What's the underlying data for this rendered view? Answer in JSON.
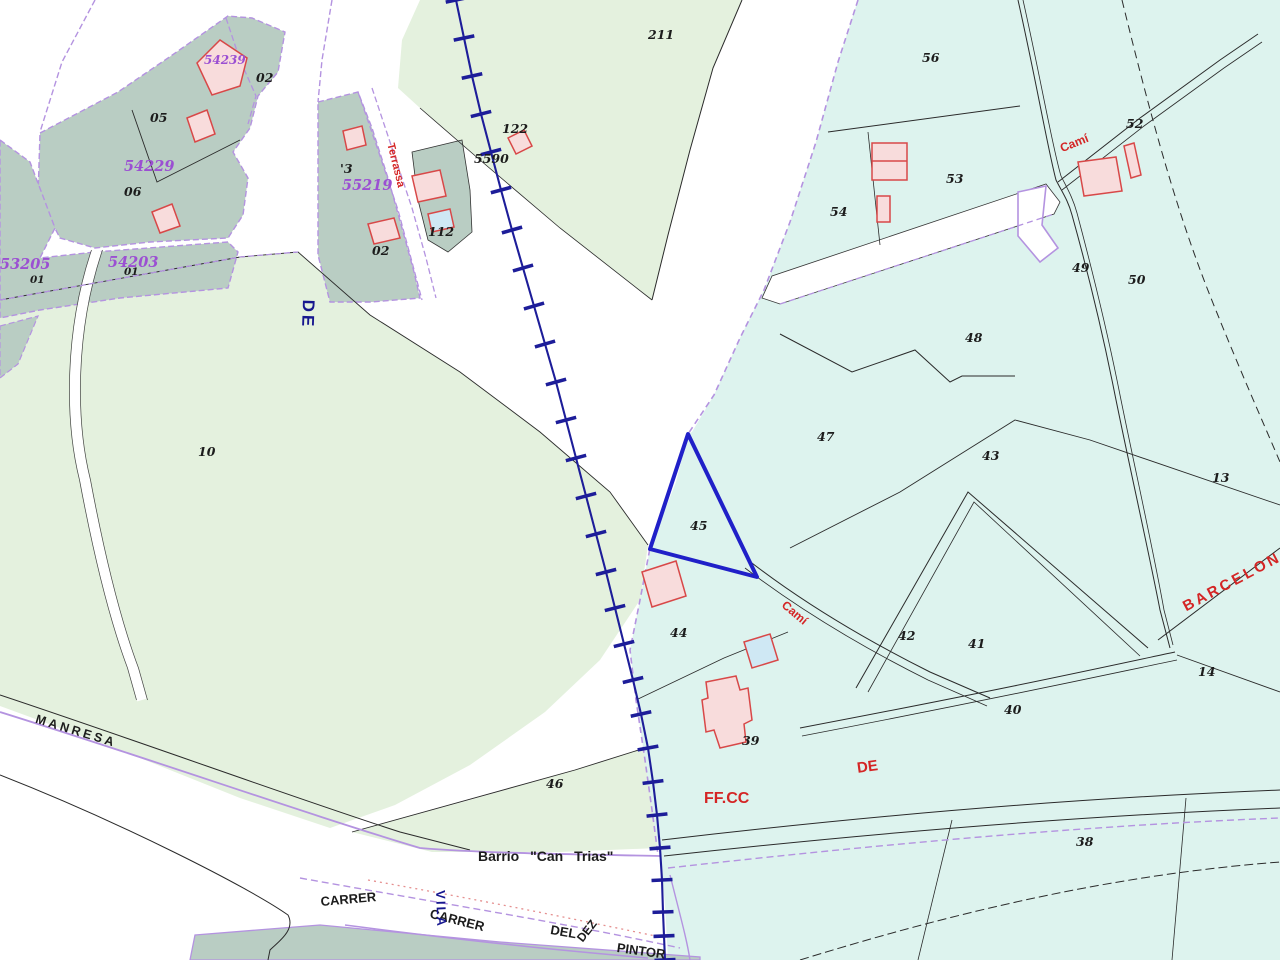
{
  "map_type": "cadastral-parcel-map",
  "colors": {
    "parcel_green": "#e4f1de",
    "parcel_sage": "#b9cdc3",
    "parcel_cyan": "#ddf3ee",
    "building_fill": "#f8dcdc",
    "building_stroke": "#d84848",
    "pool_fill": "#cfe8f4",
    "railway_blue": "#1d1d99",
    "road_purple": "#b493e0",
    "boundary_black": "#2a2a2a",
    "highlight_blue": "#2020c8",
    "label_purple": "#9b4fd2",
    "label_red": "#d42525",
    "label_blue": "#17178f",
    "dotted_pink": "#e58f8f"
  },
  "labels": {
    "p54239": "54239",
    "p54229": "54229",
    "p55219": "55219",
    "p53205": "53205",
    "p54203": "54203",
    "n01a": "01",
    "n01b": "01",
    "n02a": "02",
    "n05": "05",
    "n06": "06",
    "apo3": "'3",
    "n02b": "02",
    "n112": "112",
    "n122": "122",
    "n5590": "5590",
    "n211": "211",
    "n56": "56",
    "n53": "53",
    "n54": "54",
    "n52": "52",
    "n49": "49",
    "n50": "50",
    "n48": "48",
    "n47": "47",
    "n43": "43",
    "n13": "13",
    "n45": "45",
    "n44": "44",
    "n42": "42",
    "n41": "41",
    "n14": "14",
    "n10": "10",
    "n40": "40",
    "n39": "39",
    "n46": "46",
    "n38": "38",
    "manresa": "MANRESA",
    "barrio": "Barrio  \"Can  Trias\"",
    "carrer1": "CARRER",
    "carrer2": "CARRER",
    "del": "DEL",
    "dez": "DEZ",
    "pintor": "PINTOR",
    "vila": "VILA",
    "de_blue": "DE",
    "terrassa": "Terrassa",
    "cami_north": "Camí",
    "cami_mid": "Camí",
    "barcelona": "BARCELONA",
    "ffcc": "FF.CC",
    "de_red": "DE"
  }
}
